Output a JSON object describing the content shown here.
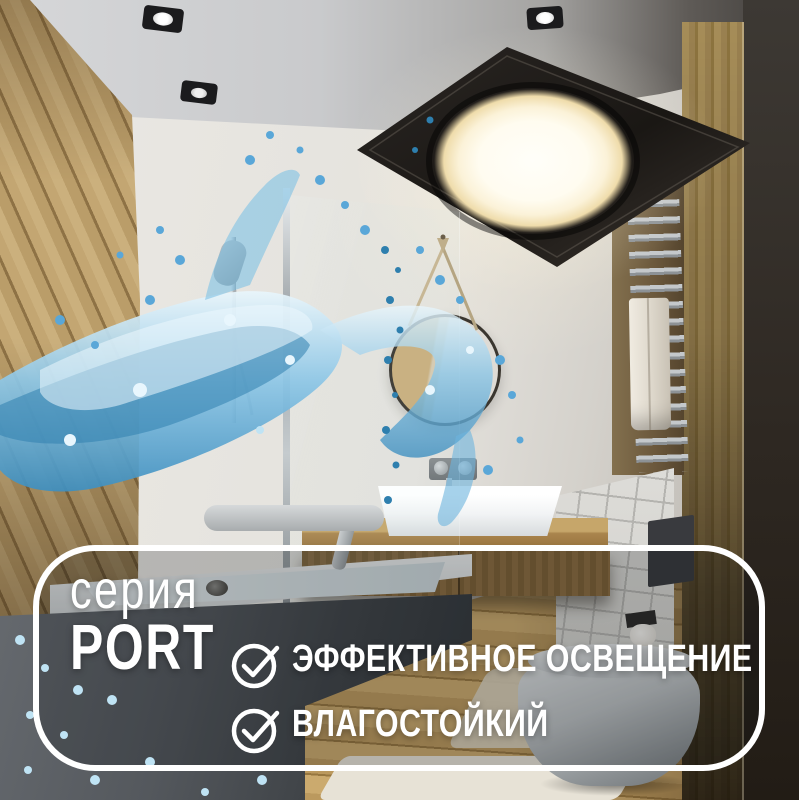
{
  "badge": {
    "series_label": "серия",
    "series_name": "PORT",
    "features": [
      {
        "icon": "check-circle-icon",
        "label": "ЭФФЕКТИВНОЕ ОСВЕЩЕНИЕ"
      },
      {
        "icon": "check-circle-icon",
        "label": "ВЛАГОСТОЙКИЙ"
      }
    ],
    "border_color": "#ffffff",
    "text_color": "#ffffff"
  },
  "scene": {
    "description": "3D render of a modern bathroom: black square ceiling LED panel with warm round glow, recessed spotlights, wood plank wall, round strap mirror over white basin on wooden vanity, glass-screened bathtub, towel radiator, wall-hung toilet, and a blue water splash across the frame",
    "colors": {
      "panel_black": "#1c1915",
      "light_glow": "#fdf6e0",
      "splash_blue": "#4a9fd4",
      "wood": "#b3925f",
      "ceiling_gray": "#c6c7c9",
      "wall_white": "#e4e2dd"
    }
  }
}
